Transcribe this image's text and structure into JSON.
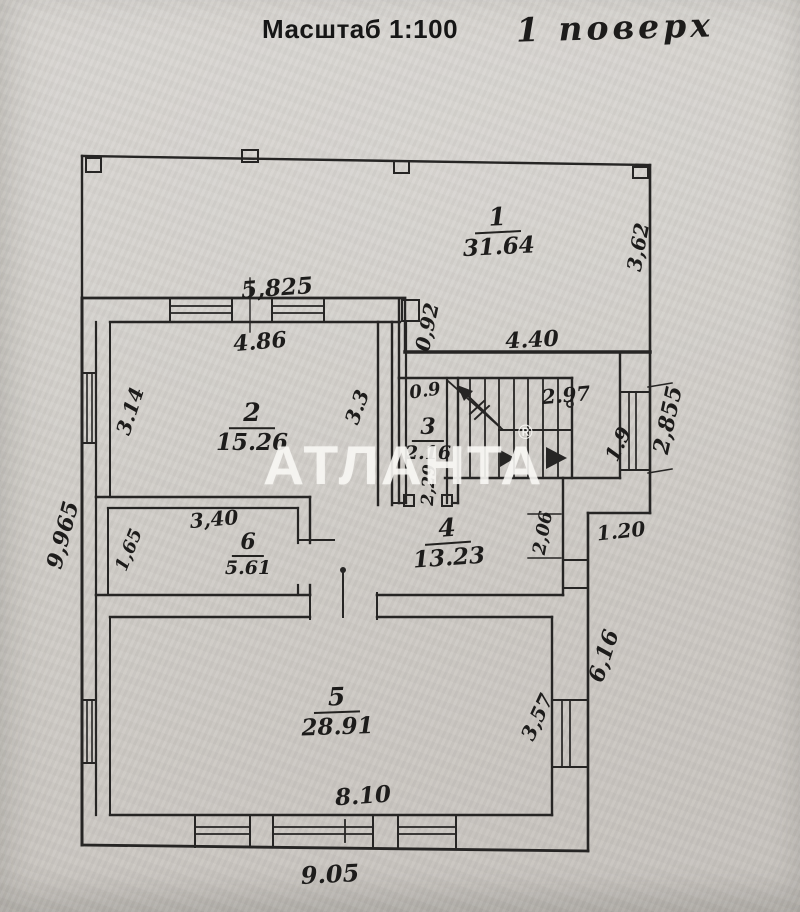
{
  "header": {
    "scale_label": "Масштаб 1:100",
    "floor_label": "1 поверх"
  },
  "watermark": {
    "brand": "АТЛАНТА",
    "registered_mark": "®"
  },
  "plan": {
    "rooms": [
      {
        "number": "1",
        "area": "31.64"
      },
      {
        "number": "2",
        "area": "15.26"
      },
      {
        "number": "3",
        "area": "2.16"
      },
      {
        "number": "4",
        "area": "13.23"
      },
      {
        "number": "5",
        "area": "28.91"
      },
      {
        "number": "6",
        "area": "5.61"
      }
    ],
    "dims": {
      "top_section_width": "5,825",
      "room2_top_width": "4.86",
      "step_depth": "0,92",
      "room1_bottom_width": "4.40",
      "room1_right_height": "3,62",
      "room2_left_height": "3.14",
      "room2_right_height": "3.3",
      "room3_top_width": "0.9",
      "stair_top_width": "2.97",
      "stair_right_height": "1.9",
      "right_window_height": "2,855",
      "room3_inner_height": "2,29",
      "right_step_height": "2,06",
      "right_step_width": "1.20",
      "room6_top_width": "3,40",
      "room6_left_height": "1,65",
      "left_total_height": "9,965",
      "right_lower_height": "6,16",
      "room5_right_height": "3,57",
      "room5_bottom_width": "8.10",
      "bottom_total_width": "9.05"
    }
  }
}
